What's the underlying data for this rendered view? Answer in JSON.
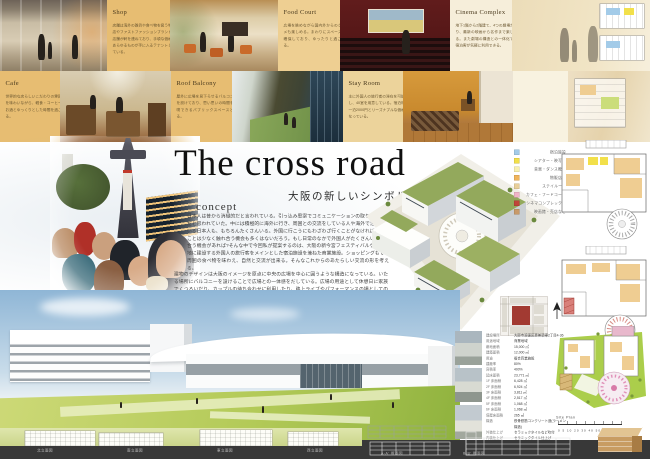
{
  "poster": {
    "title": "The cross road",
    "subtitle": "大阪の新しいシンボルに",
    "concept_label": "concept",
    "concept_p1": "日本人は昔から消極的だと言われている。引っ込み思案でコミュニケーションの取り方が下手だと思われていた。中には積極的に海外に行き、周囲との交流をしている人や海外で活躍している日本人も、もちろんたくさんいる。外国に行こうにもわざわざ行くことがなければ、行くことは少なく触れ合う機会も多くはないだろう。もし日常のなかで外国人がたくさんいて触れ合う機会があれば?そんな中で今回私が提案するのは、大阪の新今宮フェスティバルゲート跡地に建設する外国人の旅行客をメインとした宿泊施設を兼ねた商業施設。ショッピングもでき周囲の食べ物を味わえ、自然と交流が出来る。そんなこれからのあたらしい交流の形を考える。",
    "concept_p2": "建物のデザインは大阪のイメージを原点に中央の広場を中心に囲うような構造になっている。いたる場所にバルコニーを設けることで広場との一体感をだしている。広場の用途として休憩日に家族でくつろいだり、カップルの待ち合わせに利用したり、路上ライブやパフォーマンスの場としての利用スペースとなる。"
  },
  "cards": {
    "shop": {
      "title": "Shop",
      "text": "店舗は海外の雑貨や食べ物を扱う物販店やファストファッションブランドの店舗が軒を連ねており、手頃な価格であらゆるものが手に入るテナントとしている。"
    },
    "food_court": {
      "title": "Food Court",
      "text": "広場を眺めながら国内外からのグルメも楽しめる。まわりにスペースも確保しており、ゆったりと過ごせる。"
    },
    "cinema": {
      "title": "Cinema Complex",
      "text": "地下1階から2階建て、4つの劇場があり、最新の映画から名作まで楽しめる。また劇場の構造との一体化でも宿泊客が気軽に利用できる。"
    },
    "cafe": {
      "title": "Cafe",
      "text": "世界的な店らしいこだわりの雰囲気を味わいながら、軽食・コーヒー・お酒とゆっくりとした時間を過ごせる。"
    },
    "roof_balcony": {
      "title": "Roof Balcony",
      "text": "屋外に広場を見下ろせるバルコニーを設けており、思い思いの時間を満喫できるパブリックスペースとなる。"
    },
    "stay_room": {
      "title": "Stay Room",
      "text": "主に外国人の旅行者の滞在を可能とし、40室を用意している。宿泊料は一泊2000円とリーズナブルな価格になっている。"
    }
  },
  "legend": {
    "items": [
      {
        "color": "#a3cbe8",
        "label": "宿泊施設"
      },
      {
        "color": "#f2e04a",
        "label": "シアター・映写室"
      },
      {
        "color": "#f8f0b0",
        "label": "音楽・ダンス教室"
      },
      {
        "color": "#f0b45a",
        "label": "物販店舗"
      },
      {
        "color": "#e8cf9a",
        "label": "ステイルーム"
      },
      {
        "color": "#f0b4c8",
        "label": "カフェ・フードコート"
      },
      {
        "color": "#c0443a",
        "label": "シネマコンプレックス"
      },
      {
        "color": "#c89a6a",
        "label": "映画館・売店など"
      }
    ]
  },
  "project_table": {
    "rows": [
      {
        "label": "建設場所",
        "value": "大阪市浪速区恵美須東2丁目4-36"
      },
      {
        "label": "用途地域",
        "value": "商業地域"
      },
      {
        "label": "敷地面積",
        "value": "15,000 ㎡"
      },
      {
        "label": "建築面積",
        "value": "12,000 ㎡"
      },
      {
        "label": "用途",
        "value": "複合商業施設"
      },
      {
        "label": "建蔽率",
        "value": "80%"
      },
      {
        "label": "容積率",
        "value": "400%"
      },
      {
        "label": "延床面積",
        "value": "23,771 ㎡"
      },
      {
        "label": "1F 床面積",
        "value": "6,428 ㎡"
      },
      {
        "label": "2F 床面積",
        "value": "6,924 ㎡"
      },
      {
        "label": "3F 床面積",
        "value": "3,811 ㎡"
      },
      {
        "label": "4F 床面積",
        "value": "2,517 ㎡"
      },
      {
        "label": "5F 床面積",
        "value": "1,068 ㎡"
      },
      {
        "label": "6F 床面積",
        "value": "1,068 ㎡"
      },
      {
        "label": "塔屋床面積",
        "value": "265 ㎡"
      },
      {
        "label": "構造",
        "value": "鉄骨鉄筋コンクリート造(ラーメン構造)"
      },
      {
        "label": "外装仕上げ",
        "value": "セラミックタイルなど吹付"
      },
      {
        "label": "内装仕上げ",
        "value": "セラミックタイル仕上げ"
      },
      {
        "label": "設計製図",
        "value": "42枚(本館1〜配置詳細ほか18枚)"
      }
    ]
  },
  "site_plan": {
    "label": "Site Plan",
    "scale": "0  5  10  20  30  40  50m"
  },
  "footer": {
    "elevation_labels": [
      "北立面図",
      "南立面図",
      "東立面図",
      "西立面図"
    ],
    "section_labels": [
      "A-A' 断面図",
      "B-B' 断面図"
    ]
  },
  "colors": {
    "card_tan": "#e7bd72",
    "card_cream": "#f6eeda",
    "site_red": "#a23a32",
    "plan_green": "#abce4b",
    "plaza_pink": "#e090b8",
    "sky_blue": "#9fc0da",
    "roof_olive": "#93a95c"
  }
}
